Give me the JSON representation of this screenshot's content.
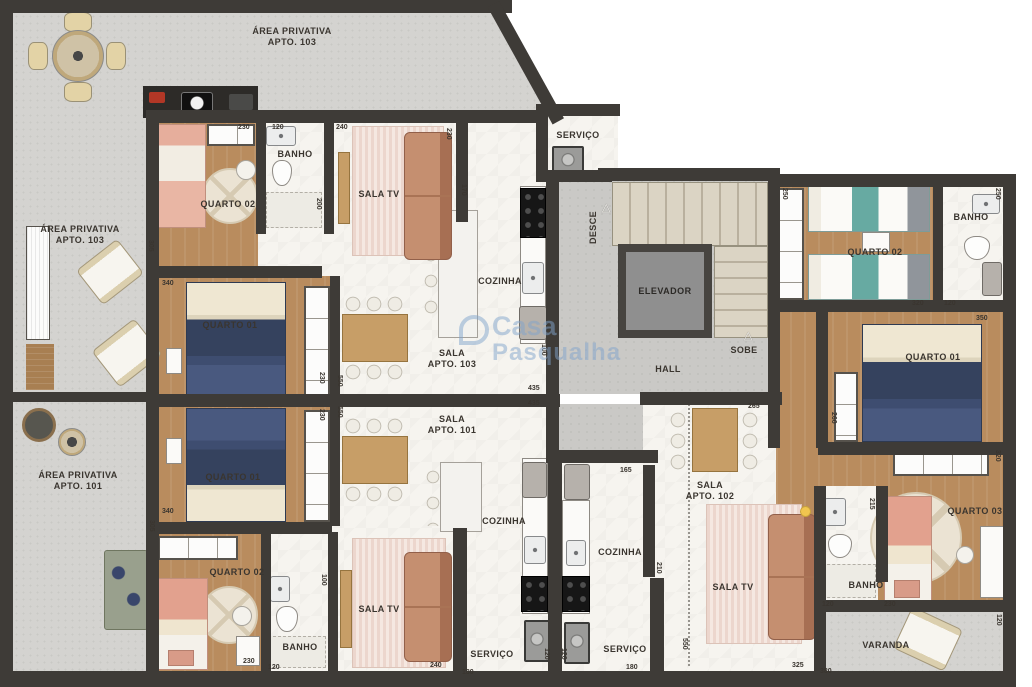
{
  "watermark": {
    "line1": "Casa",
    "line2": "Pasqualha"
  },
  "icons": {
    "desce_arrow": "△",
    "sobe_arrow": "△"
  },
  "colors": {
    "wall": "#3e3b37",
    "patio": "#d4d3d0",
    "wood_floor": "#b98c5e",
    "marble_floor": "#f6f4ef",
    "navy_bed": "#35425e",
    "salmon_sofa": "#c58f70",
    "teal_bed": "#67aaa2",
    "pink_bed": "#e6b1a0"
  },
  "labels": {
    "area_priv_103_top": "ÁREA PRIVATIVA\nAPTO. 103",
    "area_priv_103_left": "ÁREA PRIVATIVA\nAPTO. 103",
    "area_priv_101": "ÁREA PRIVATIVA\nAPTO. 101",
    "quarto02_103": "QUARTO 02",
    "banho_103": "BANHO",
    "sala_tv_103": "SALA TV",
    "quarto01_103": "QUARTO 01",
    "cozinha_103": "COZINHA",
    "sala_103": "SALA\nAPTO. 103",
    "servico_top": "SERVIÇO",
    "desce": "DESCE",
    "sobe": "SOBE",
    "elevador": "ELEVADOR",
    "hall": "HALL",
    "quarto02_102": "QUARTO 02",
    "banho_102_top": "BANHO",
    "quarto01_102": "QUARTO 01",
    "sala_102": "SALA\nAPTO. 102",
    "sala_tv_102": "SALA TV",
    "cozinha_102": "COZINHA",
    "servico_102": "SERVIÇO",
    "quarto03_102": "QUARTO 03",
    "banho_102_bottom": "BANHO",
    "varanda": "VARANDA",
    "quarto01_101": "QUARTO 01",
    "quarto02_101": "QUARTO 02",
    "banho_101": "BANHO",
    "sala_tv_101": "SALA TV",
    "sala_101": "SALA\nAPTO. 101",
    "cozinha_101": "COZINHA",
    "servico_101": "SERVIÇO"
  },
  "dims": {
    "q02t_230": "230",
    "banho103_120": "120",
    "salatv103_240": "240",
    "salatv103_230": "230",
    "banho103_200": "200",
    "q02_103_305": "305",
    "q01_103_340": "340",
    "mid_230_a": "230",
    "mid_550_a": "550",
    "mid_230_b": "230",
    "mid_550_b": "550",
    "cozinha103_170": "170",
    "hall_100": "100",
    "hall_435_a": "435",
    "hall_435_b": "435",
    "stair_250": "250",
    "banho102_250": "250",
    "q02_102_320": "320",
    "banho102_120": "120",
    "q01_102_350": "350",
    "q01_102_260": "260",
    "q03_320": "320",
    "q03_215": "215",
    "banho102b_120": "120",
    "q03_230": "230",
    "varanda_120": "120",
    "varanda_380": "380",
    "sala102_265": "265",
    "sala102_165": "165",
    "cozinha102_210": "210",
    "sala102_550": "550",
    "sala102_325": "325",
    "servico101_180": "180",
    "servico102_180": "180",
    "servico_120_a": "120",
    "servico_120_b": "120",
    "salatv101_240": "240",
    "q02_101_230": "230",
    "banho101_120": "120",
    "q01_101_340": "340",
    "q02_101_305": "305",
    "banho101_100": "100"
  }
}
